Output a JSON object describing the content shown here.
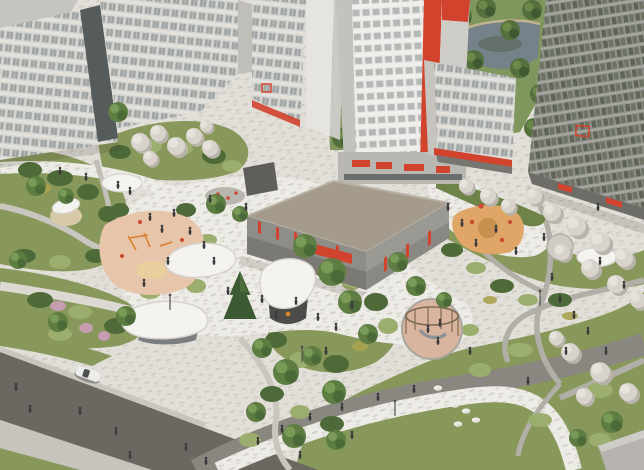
{
  "meta": {
    "title": "Aerial architectural rendering of a residential complex courtyard",
    "type": "3d-visualization",
    "width": 644,
    "height": 470
  },
  "palette": {
    "paving": "#e2dfd9",
    "paving_white": "#edebe6",
    "lawn": "#87985a",
    "lawn_dark": "#6d8348",
    "shrub": "#4f6a39",
    "shrub_light": "#9cae6e",
    "olive": "#a9a24f",
    "tree": "#5d7d42",
    "tree_dark": "#3f5c33",
    "blossom": "#d8d3cb",
    "blossom_shadow": "#b9b4ab",
    "pink_tree": "#c59fb0",
    "road": "#6b6761",
    "street": "#8a8781",
    "sidewalk": "#c7c4be",
    "path": "#b2afa8",
    "path_light": "#dcd9d3",
    "plaza_blue": "#b8bcc6",
    "building_white": "#d7d5d0",
    "building_trim": "#c6c4c0",
    "glass_dark": "#565b5b",
    "tower_white": "#eceae6",
    "tower_side": "#cfcdc8",
    "accent_red": "#d2432e",
    "garage_roof": "#a49b8d",
    "garage_facade": "#8f8d88",
    "garage_facade_light": "#9b9994",
    "garage_slat": "#7b7974",
    "right_tower": "#90918b",
    "right_tower_win": "#5f6459",
    "base_dark": "#6e6c66",
    "park": "#7f975c",
    "park_tree": "#55703f",
    "pond": "#76828a",
    "pond_dark": "#55624f",
    "bank": "#c2b291",
    "canopy": "#f4f3f0",
    "canopy_edge": "#d6d3cd",
    "pavilion_base": "#4b4b49",
    "playground_pink": "#e6c5aa",
    "playground_sand": "#e8cf9e",
    "playground_orange": "#dfa667",
    "cage_floor": "#d9b49e",
    "cage_frame": "#7d6a55",
    "equipment_orange": "#d7812f",
    "rock_white": "#efede8",
    "car": "#ececea",
    "car_glass": "#4a4f52",
    "person": "#3a3a3c",
    "shadow": "rgba(60,55,45,0.16)"
  },
  "scene": {
    "elements": [
      {
        "name": "residential-building-left",
        "label": "White apartment slabs (left)"
      },
      {
        "name": "central-tower",
        "label": "White tower with red corner stripe"
      },
      {
        "name": "right-tower",
        "label": "Gray glass tower (right)"
      },
      {
        "name": "mid-building",
        "label": "Mid-rise building with red awning"
      },
      {
        "name": "parking-garage",
        "label": "Two-level parking garage with red accents"
      },
      {
        "name": "park",
        "label": "Park with pond (background)"
      },
      {
        "name": "pond",
        "label": "Pond"
      },
      {
        "name": "courtyard-plaza",
        "label": "Paved courtyard plaza"
      },
      {
        "name": "playground-left",
        "label": "Toddler playground, salmon rubber surface"
      },
      {
        "name": "playground-orange",
        "label": "Climbing playground, orange surface"
      },
      {
        "name": "playground-rope-cage",
        "label": "Circular rope-climbing structure"
      },
      {
        "name": "shade-canopy",
        "label": "White free-form shade canopies"
      },
      {
        "name": "pavilion",
        "label": "Courtyard pavilion with white roof"
      },
      {
        "name": "umbrella",
        "label": "Round white umbrella"
      },
      {
        "name": "road",
        "label": "Asphalt street (bottom left)"
      },
      {
        "name": "sidewalk",
        "label": "Sidewalk with pedestrians"
      },
      {
        "name": "car",
        "label": "White car"
      },
      {
        "name": "person",
        "label": "Pedestrian"
      },
      {
        "name": "lawn",
        "label": "Lawns and planting beds"
      },
      {
        "name": "blossom-tree",
        "label": "White blossoming tree"
      },
      {
        "name": "green-tree",
        "label": "Deciduous tree"
      },
      {
        "name": "spruce-tree",
        "label": "Spruce tree"
      },
      {
        "name": "rock-sculptures",
        "label": "White decorative boulders"
      },
      {
        "name": "street-lamp",
        "label": "Street lamp"
      }
    ]
  }
}
